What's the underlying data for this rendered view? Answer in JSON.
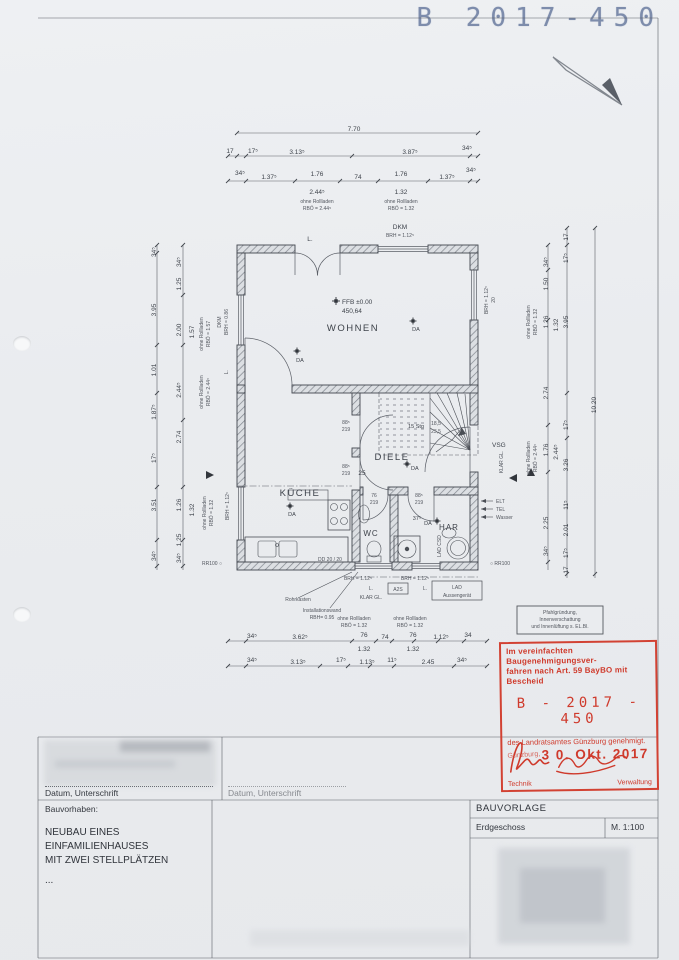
{
  "colors": {
    "stamp_red": "#cf3a2c",
    "header_blue": "#7484a6",
    "ink": "#41454d"
  },
  "header": {
    "doc_number": "B 2017-450"
  },
  "plan": {
    "rooms": {
      "wohnen": "WOHNEN",
      "diele": "DIELE",
      "kueche": "KÜCHE",
      "wc": "WC",
      "har": "HAR"
    },
    "level": {
      "ffb": "FFB ±0.00",
      "alt": "450,64"
    },
    "marker_da": "DA",
    "stair": {
      "count": "15 Stg",
      "rise": "18,5",
      "run": "23,5"
    },
    "labels": {
      "l": "L.",
      "dkm": "DKM",
      "brh112": "BRH = 1.12⁵",
      "brh086": "BRH = 0.86",
      "w20": "20",
      "vsg": "VSG",
      "klar": "KLAR GL.",
      "elt": "ELT",
      "tel": "TEL",
      "wasser": "Wasser",
      "rr_l": "RR100 ○",
      "rr_r": "○ RR100",
      "rohrkasten": "Rohrkasten",
      "inst1": "Installationswand",
      "inst2": "RBH= 0.95",
      "a2s": "A2S",
      "lad1": "LAD",
      "lad2": "Aussengerät",
      "lad_csd": "LAD CSD",
      "ohne": "ohne Rollladen",
      "rbo244": "RBÖ = 2.44⁵",
      "rbo132": "RBÖ = 1.32",
      "rbo157": "RBÖ = 1.57",
      "dd": "DD 20 / 20",
      "d25": "25",
      "d375": "37⁵",
      "d88": "88⁵",
      "d76": "76",
      "d219": "219"
    },
    "dims": {
      "top_total": "7.70",
      "top2": [
        "17",
        "17⁵",
        "3.13⁵",
        "3.87⁵",
        "34⁵"
      ],
      "top3": [
        "34⁵",
        "1.37⁵",
        "1.76",
        "74",
        "1.76",
        "1.37⁵",
        "34⁵"
      ],
      "win_l": "2.44⁵",
      "win_r": "1.32",
      "leftA": [
        "34⁵",
        "3.95",
        "1.01",
        "1.87⁵",
        "17⁵",
        "3.51",
        "34⁵"
      ],
      "leftB": [
        "34⁵",
        "1.25",
        "2.00",
        "2.44⁵",
        "2.74",
        "1.26",
        "1.25",
        "34⁵"
      ],
      "leftB2": [
        "1.57",
        "1.32"
      ],
      "rightC": [
        "34⁵",
        "1.50",
        "1.26",
        "2.74",
        "1.76",
        "2.25",
        "34⁵"
      ],
      "rightC2": [
        "1.32",
        "2.44⁵"
      ],
      "rightD": [
        "17",
        "17⁵",
        "3.95",
        "17⁵",
        "3.26",
        "11⁵",
        "2.01",
        "17⁵",
        "17"
      ],
      "right_total": "10.20",
      "bottom1": [
        "34⁵",
        "3.62⁵",
        "76",
        "74",
        "76",
        "1.12⁵",
        "34"
      ],
      "bottom1b": [
        "1.32",
        "1.32"
      ],
      "bottom2": [
        "34⁵",
        "3.13⁵",
        "17⁵",
        "1.13⁵",
        "11⁵",
        "2.45",
        "34⁵"
      ]
    }
  },
  "pfahl_box": {
    "l1": "Pfahlgründung,",
    "l2": "Innenverschattung",
    "l3": "und Innenlüftung s. EL.Bl."
  },
  "stamp": {
    "line1": "Im vereinfachten Baugenehmigungsver-",
    "line2": "fahren nach Art. 59 BayBO mit Bescheid",
    "number": "B - 2017 - 450",
    "line3": "des Landratsamtes Günzburg genehmigt.",
    "city": "Günzburg,",
    "date": "3 0. Okt. 2017",
    "sig_left": "Technik",
    "sig_right": "Verwaltung"
  },
  "titleblock": {
    "datum_left": "Datum, Unterschrift",
    "datum_right": "Datum, Unterschrift",
    "bauvorhaben": "Bauvorhaben:",
    "project": [
      "NEUBAU EINES",
      "EINFAMILIENHAUSES",
      "MIT ZWEI STELLPLÄTZEN",
      "..."
    ],
    "bauvorlage": "BAUVORLAGE",
    "floor": "Erdgeschoss",
    "scale": "M. 1:100"
  }
}
